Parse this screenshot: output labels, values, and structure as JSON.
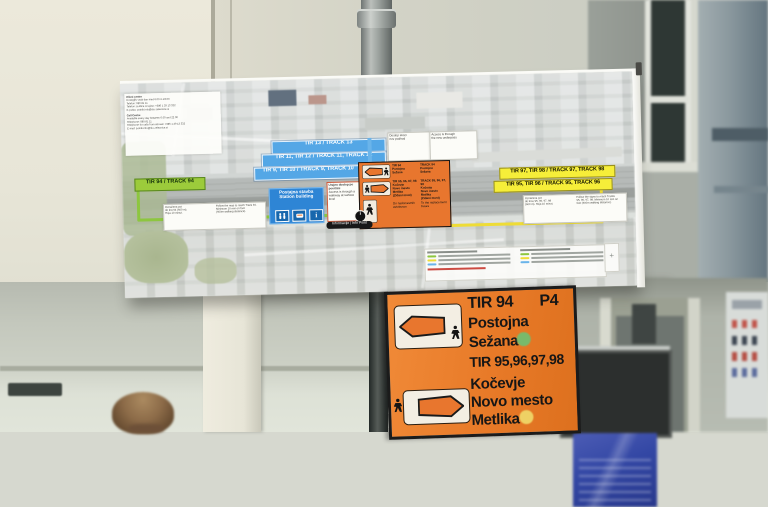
{
  "colors": {
    "bus_sign_orange": "#e87a28",
    "map_highlight_orange": "#e8762e",
    "track_bar_blue": "#54a7e6",
    "station_box_blue": "#2e85d5",
    "track94_green": "#9ccb3b",
    "track9598_yellow": "#f6ee39",
    "route_green": "#8dc63f",
    "route_yellow": "#eedc36",
    "underpass_blue": "#6ab4ea",
    "dot_green": "#6fbf72",
    "dot_yellow": "#f0d96a"
  },
  "glyphs": {
    "info": "i",
    "compass": "+"
  },
  "map_sign": {
    "info_box": {
      "sl": [
        "Klicni center",
        "Dosegljiv vsak dan med 6.00 in 22.00",
        "Telefon: 080 81 11",
        "Telefon za klice iz tujine: +386 1 29 13 332",
        "E-pošta: potnik.info@slo-zeleznice.si"
      ],
      "en": [
        "Call Centre",
        "Available every day between 6.00 and 22.00",
        "Telephone: 080 81 11",
        "Telephone for calls from abroad: +386 1 29 13 332",
        "E-mail: potnik.info@slo-zeleznice.si"
      ]
    },
    "track_bars": [
      "TIR 13 / TRACK 13",
      "TIR 11, TIR 12 / TRACK 11, TRACK 12",
      "TIR 9, TIR 10 / TRACK 9, TRACK 10"
    ],
    "underpass_sl": "Dostop skozi\nnov podhod",
    "underpass_en": "Access is through\nthe new underpass",
    "station_building_sl": "Postajna stavba",
    "station_building_en": "Station building",
    "surface_access_sl": "Urejen dostop po\npovršini",
    "surface_access_en": "Access is through a\nwalkway at surface\nlevel",
    "info_point_label": "Informacije | Info Point",
    "track94_label": "TIR 94 / TRACK 94",
    "track94_route_sl": "Označena pot\ndo tira 94 (600 m).\nHoja 10 minut.",
    "track94_route_en": "Follow the map to reach Track 94.\nMinimum 10 min on foot\n(600m walking distance).",
    "track9798_label": "TIR 97, TIR 98 / TRACK 97, TRACK 98",
    "track9596_label": "TIR 95, TIR 96 / TRACK 95, TRACK 96",
    "track9598_route_sl": "Označena pot\ndo tirov 95, 96, 97, 98\n(600 m). Hoja 10 minut.",
    "track9598_route_en": "Follow the signs to reach Tracks\n95, 96, 97, 98. Minimum 10 min on\nfoot (600m walking distance).",
    "bus_box": {
      "row1_sl": "TIR 94\nPostojna\nSežana",
      "row1_en": "TRACK 94\nPostojna\nSežana",
      "row2_sl": "TIR 95, 96, 97, 98\nKočevje\nNovo mesto\nMetlika\n(Zidani most)",
      "row2_en": "TRACK 95, 96, 97, 98\nKočevje\nNovo mesto\nMetlika\n(Zidani most)",
      "row3_sl": "Do nadomestnih\navtobusov",
      "row3_en": "To the replacement\nbuses"
    }
  },
  "bus_sign": {
    "row1": {
      "track": "TIR 94",
      "platform": "P4",
      "destinations": "Postojna\nSežana"
    },
    "row2": {
      "track": "TIR 95,96,97,98",
      "destinations": "Kočevje\nNovo mesto\nMetlika"
    }
  }
}
